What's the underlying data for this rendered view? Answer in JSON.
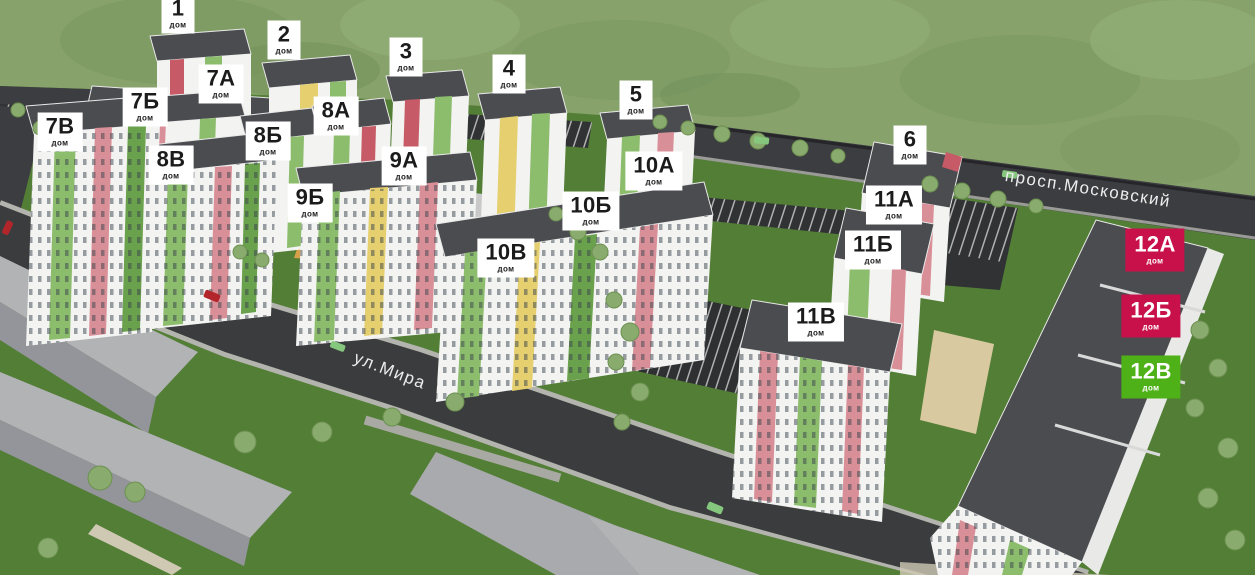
{
  "scene": {
    "description": "3D masterplan of residential complex with numbered building markers",
    "label_sub": "дом"
  },
  "colors": {
    "label_white_bg": "#ffffff",
    "label_text_dark": "#1b1b1b",
    "label_red_bg": "#c8114b",
    "label_green_bg": "#4db117",
    "label_colored_text": "#ffffff",
    "road_asphalt": "#3b3c3e",
    "grass_dark": "#527e36",
    "hill_green": "#87a26b",
    "building_white": "#f3f3f1",
    "roof_dark": "#4b4c50",
    "accent_green": "#8cbd6d",
    "accent_pink": "#d98f97",
    "accent_yellow": "#e5cf6e",
    "context_gray": "#a9aaae"
  },
  "labels": [
    {
      "id": "1",
      "number": "1",
      "variant": "white",
      "x": 178,
      "y": 14
    },
    {
      "id": "2",
      "number": "2",
      "variant": "white",
      "x": 284,
      "y": 40
    },
    {
      "id": "3",
      "number": "3",
      "variant": "white",
      "x": 406,
      "y": 57
    },
    {
      "id": "4",
      "number": "4",
      "variant": "white",
      "x": 509,
      "y": 74
    },
    {
      "id": "5",
      "number": "5",
      "variant": "white",
      "x": 636,
      "y": 100
    },
    {
      "id": "6",
      "number": "6",
      "variant": "white",
      "x": 910,
      "y": 145
    },
    {
      "id": "7a",
      "number": "7А",
      "variant": "white",
      "x": 221,
      "y": 84
    },
    {
      "id": "7b",
      "number": "7Б",
      "variant": "white",
      "x": 145,
      "y": 107
    },
    {
      "id": "7v",
      "number": "7В",
      "variant": "white",
      "x": 60,
      "y": 132
    },
    {
      "id": "8a",
      "number": "8А",
      "variant": "white",
      "x": 336,
      "y": 116
    },
    {
      "id": "8b",
      "number": "8Б",
      "variant": "white",
      "x": 268,
      "y": 141
    },
    {
      "id": "8v",
      "number": "8В",
      "variant": "white",
      "x": 171,
      "y": 165
    },
    {
      "id": "9a",
      "number": "9А",
      "variant": "white",
      "x": 404,
      "y": 166
    },
    {
      "id": "9b",
      "number": "9Б",
      "variant": "white",
      "x": 310,
      "y": 203
    },
    {
      "id": "10a",
      "number": "10А",
      "variant": "white",
      "x": 654,
      "y": 171
    },
    {
      "id": "10b",
      "number": "10Б",
      "variant": "white",
      "x": 591,
      "y": 211
    },
    {
      "id": "10v",
      "number": "10В",
      "variant": "white",
      "x": 506,
      "y": 258
    },
    {
      "id": "11a",
      "number": "11А",
      "variant": "white",
      "x": 894,
      "y": 205
    },
    {
      "id": "11b",
      "number": "11Б",
      "variant": "white",
      "x": 873,
      "y": 250
    },
    {
      "id": "11v",
      "number": "11В",
      "variant": "white",
      "x": 816,
      "y": 322
    },
    {
      "id": "12a",
      "number": "12А",
      "variant": "red",
      "x": 1155,
      "y": 250
    },
    {
      "id": "12b",
      "number": "12Б",
      "variant": "red",
      "x": 1151,
      "y": 316
    },
    {
      "id": "12v",
      "number": "12В",
      "variant": "green",
      "x": 1151,
      "y": 377
    }
  ],
  "streets": [
    {
      "id": "mira",
      "name": "ул.Мира",
      "x": 390,
      "y": 371,
      "rotation": 21
    },
    {
      "id": "moskovsky",
      "name": "просп.Московский",
      "x": 1088,
      "y": 189,
      "rotation": 9
    }
  ]
}
